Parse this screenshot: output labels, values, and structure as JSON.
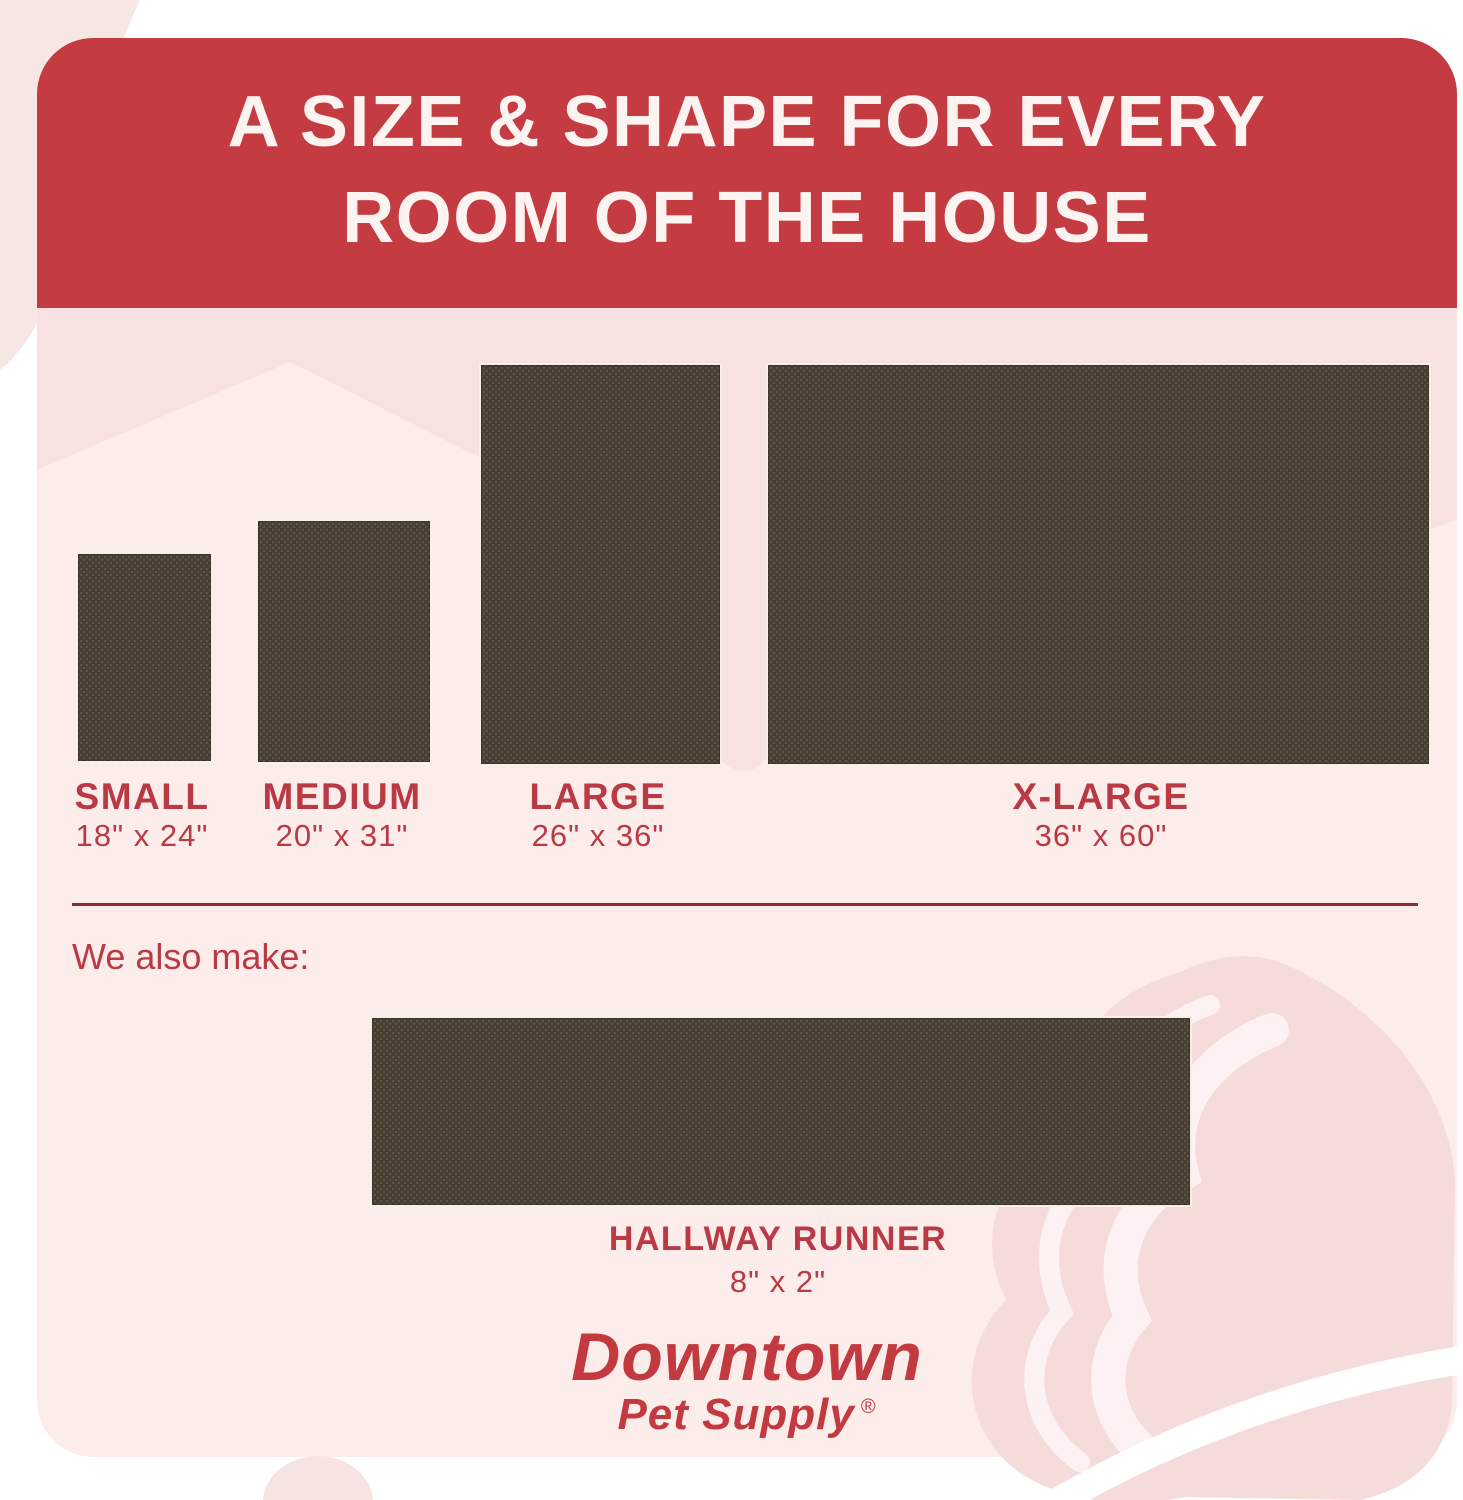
{
  "header": {
    "title_line1": "A SIZE & SHAPE FOR EVERY",
    "title_line2": "ROOM OF THE HOUSE"
  },
  "sizes": [
    {
      "label": "SMALL",
      "dimensions": "18\" x 24\""
    },
    {
      "label": "MEDIUM",
      "dimensions": "20\" x 31\""
    },
    {
      "label": "LARGE",
      "dimensions": "26\" x 36\""
    },
    {
      "label": "X-LARGE",
      "dimensions": "36\" x 60\""
    }
  ],
  "also_make": {
    "intro": "We also make:",
    "label": "HALLWAY RUNNER",
    "dimensions": "8\" x 2\""
  },
  "brand": {
    "name": "Downtown",
    "tagline": "Pet Supply",
    "registered": "®"
  },
  "colors": {
    "header_red": "#c43c42",
    "accent_crimson": "#b93a45",
    "card_pink": "#fcedeb",
    "swoosh_pink": "#f8e2e1",
    "blob_pink": "#f5dcdb",
    "rug_brown": "#453d33"
  }
}
